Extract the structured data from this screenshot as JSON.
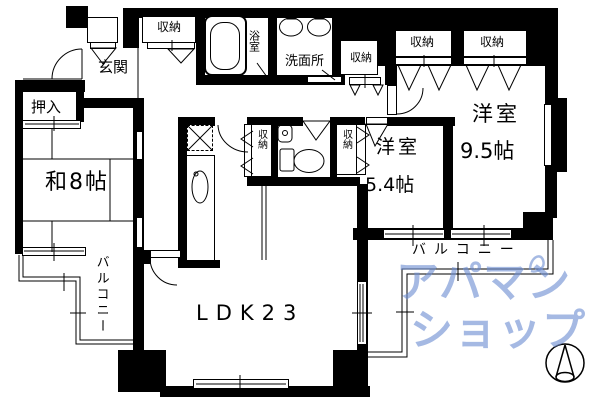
{
  "floorplan": {
    "rooms": {
      "genkan": "玄関",
      "oshiire": "押入",
      "washitsu": "和8帖",
      "bedroom1_name": "洋室",
      "bedroom1_size": "9.5帖",
      "bedroom2_name": "洋室",
      "bedroom2_size": "5.4帖",
      "ldk": "LDK23",
      "bathroom": "浴室",
      "washroom": "洗面所",
      "balcony_left": "バルコニー",
      "balcony_right": "バルコニー"
    },
    "storages": [
      "収納",
      "収納",
      "収納",
      "収納",
      "収納",
      "収納"
    ],
    "watermark": {
      "line1": "アパマン",
      "line2": "ショップ",
      "color": "#6f8fd2"
    },
    "colors": {
      "wall": "#000000",
      "background": "#ffffff"
    }
  }
}
